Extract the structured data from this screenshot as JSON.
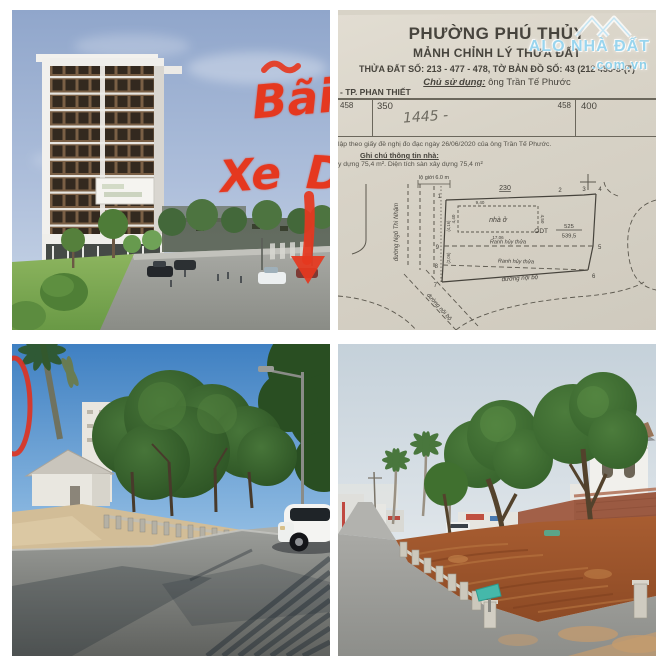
{
  "annotation": {
    "word1": "Bãi",
    "word2": "Xe",
    "word3": "D",
    "color": "#e5381f"
  },
  "watermark": {
    "brand": "ALO NHÀ ĐẤT",
    "domain": ".com.vn",
    "color": "#8fd0e9"
  },
  "document": {
    "title1": "PHƯỜNG PHÚ THỦY",
    "title2": "MẢNH CHỈNH LÝ THỬA ĐẤT",
    "parcel_line": "THỬA ĐẤT SỐ: 213 - 477 - 478, TỜ BẢN ĐỒ SỐ: 43 (212 458-8-(7)",
    "owner_label": "Chủ sử dụng:",
    "owner_name": " ông Trần Tế Phước",
    "city_line": "- TP. PHAN THIẾT",
    "grid": {
      "left_num": "458",
      "left_val": "350",
      "handwritten": "1445 -",
      "right_num": "458",
      "right_val": "400"
    },
    "note1": "lập theo giấy đề nghị đo đạc ngày 26/06/2020 của ông Trần Tế Phước.",
    "note2": "Ghi chú thông tin nhà:",
    "note3": "y dựng 75,4 m². Diện tích sàn xây dựng 75,4 m²",
    "drawing": {
      "setback": "lộ giới 6.0 m",
      "dim_230": "230",
      "house": "nhà ở",
      "odt": "ODT",
      "odt_top": "525",
      "odt_bottom": "539,5",
      "ranh1": "Ranh hủy thửa",
      "ranh2": "Ranh hủy thửa",
      "road_bottom": "đường nội bộ",
      "road_diag": "đường nội bộ",
      "street_left": "đường Ngô Thì Nhậm",
      "dim_house_top": "9,40",
      "dim_house_bottom": "17,06",
      "dim_house_right": "4,50",
      "dim_house_left": "4,40",
      "dim_left1": "(4,16)",
      "dim_left2": "(2,06)",
      "v1": "1",
      "v2": "2",
      "v3": "3",
      "v4": "4",
      "v5": "5",
      "v6": "6",
      "v7": "7",
      "v8": "8",
      "v9": "9"
    }
  }
}
